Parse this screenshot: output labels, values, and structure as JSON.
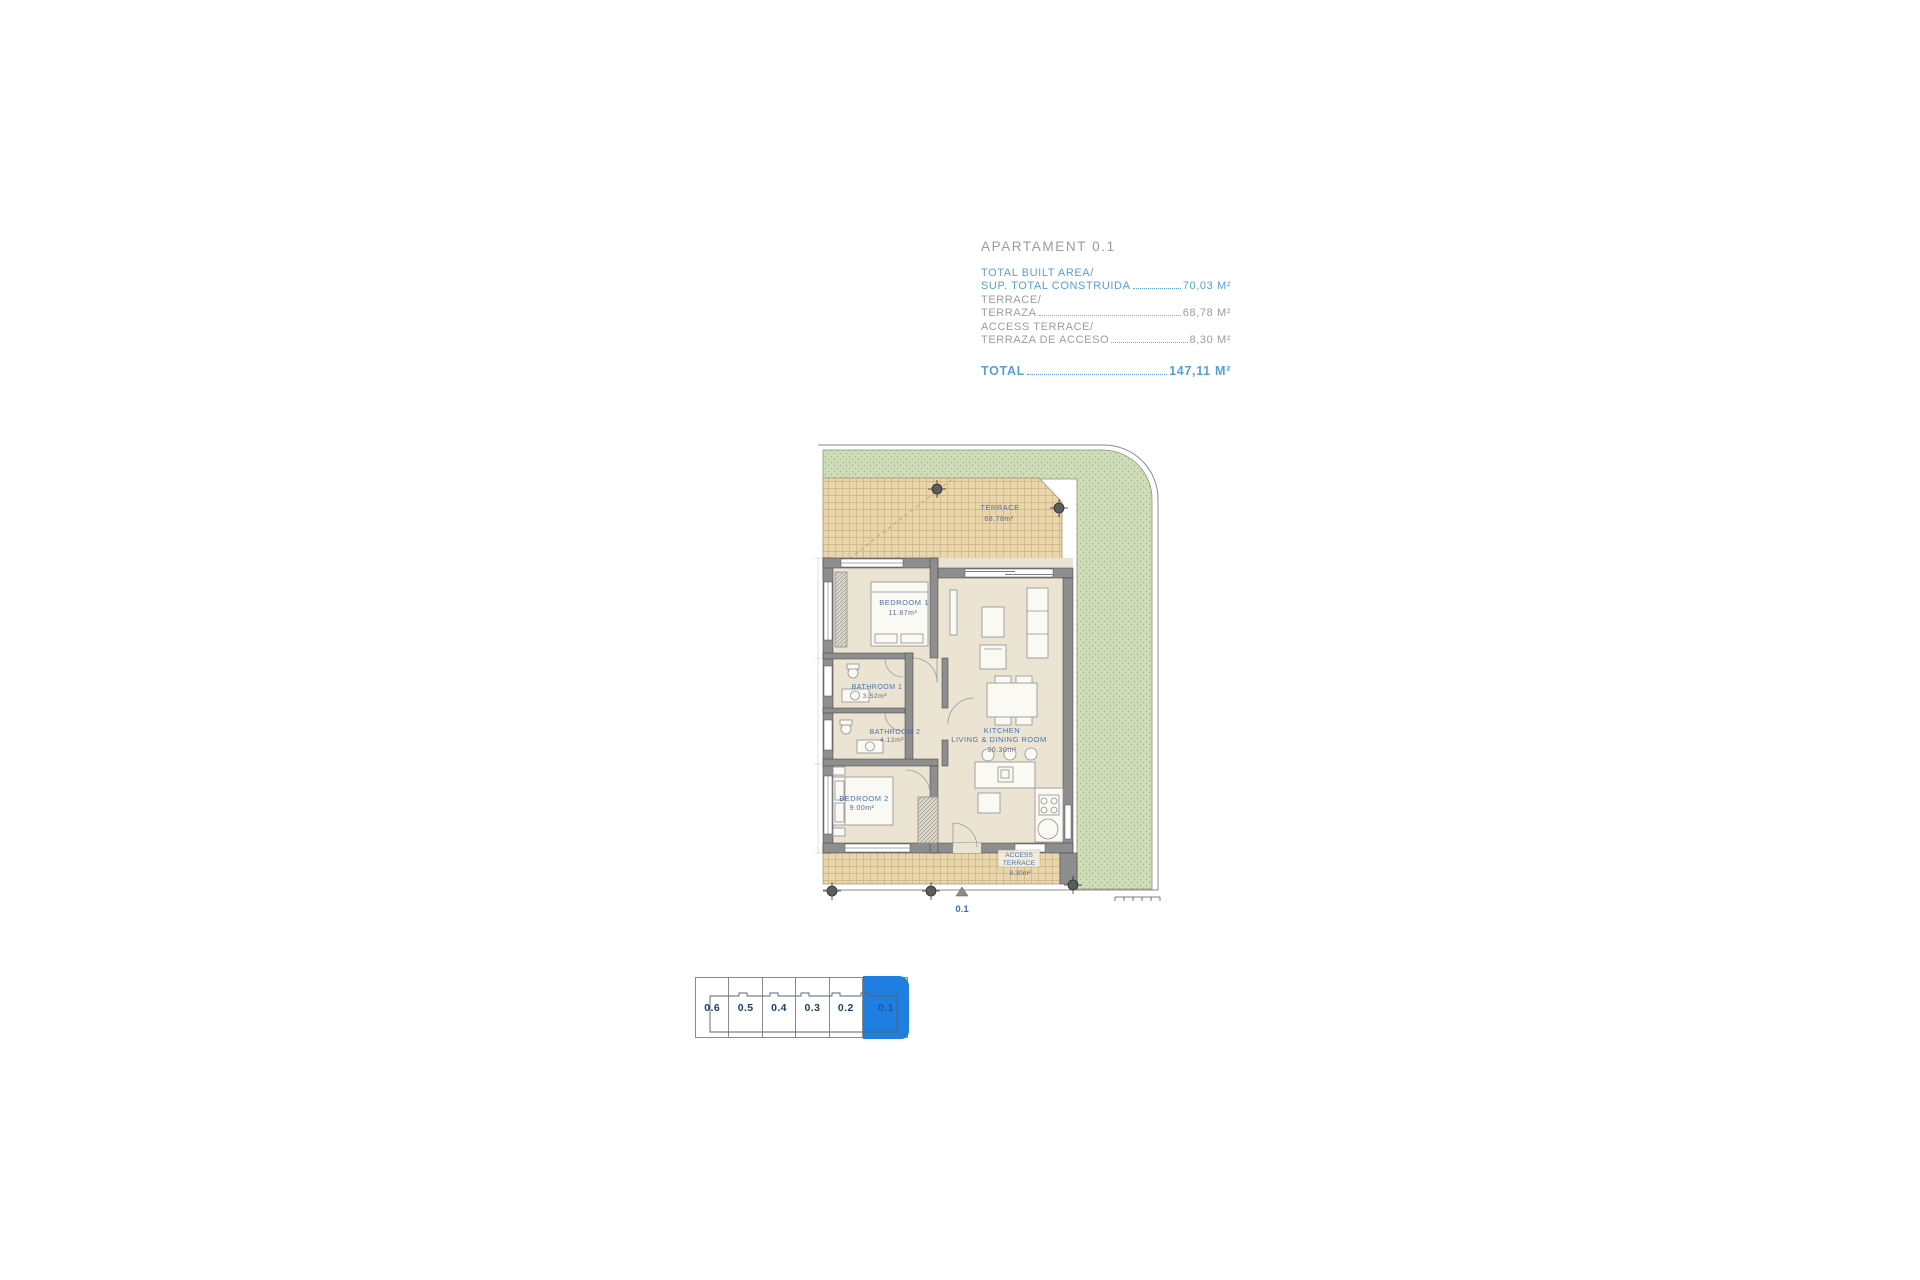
{
  "header": {
    "title": "APARTAMENT 0.1",
    "rows": [
      {
        "label_en": "TOTAL BUILT AREA/",
        "label_es": "SUP. TOTAL CONSTRUIDA",
        "value": "70,03 M²",
        "style": "blue"
      },
      {
        "label_en": "TERRACE/",
        "label_es": "TERRAZA",
        "value": "68,78 M²",
        "style": "gray"
      },
      {
        "label_en": "ACCESS TERRACE/",
        "label_es": "TERRAZA DE ACCESO",
        "value": "8,30 M²",
        "style": "gray"
      }
    ],
    "total_label": "TOTAL",
    "total_value": "147,11 M²"
  },
  "plan": {
    "terrace": {
      "name": "TERRACE",
      "area": "68.78m²"
    },
    "bedroom1": {
      "name": "BEDROOM 1",
      "area": "11.87m²"
    },
    "bathroom1": {
      "name": "BATHROOM 1",
      "area": "3.52m²"
    },
    "bathroom2": {
      "name": "BATHROOM 2",
      "area": "4.12m²"
    },
    "bedroom2": {
      "name": "BEDROOM 2",
      "area": "9.00m²"
    },
    "kitchen": {
      "name": "KITCHEN",
      "name2": "LIVING & DINING ROOM",
      "area": "30.30m²"
    },
    "access_terrace": {
      "name": "ACCESS",
      "name2": "TERRACE",
      "area": "8.30m²"
    },
    "entry_label": "0.1"
  },
  "selector": {
    "units": [
      {
        "label": "0.6",
        "selected": false
      },
      {
        "label": "0.5",
        "selected": false
      },
      {
        "label": "0.4",
        "selected": false
      },
      {
        "label": "0.3",
        "selected": false
      },
      {
        "label": "0.2",
        "selected": false
      },
      {
        "label": "0.1",
        "selected": true
      }
    ]
  },
  "colors": {
    "accent_blue": "#1f7fe0",
    "label_blue": "#4a72ad",
    "header_blue": "#58a0d2",
    "header_gray": "#9c9c9f",
    "garden_green": "#cfddb9",
    "terrace_tan": "#e9d7ab",
    "wall_gray": "#8e8e8e"
  }
}
